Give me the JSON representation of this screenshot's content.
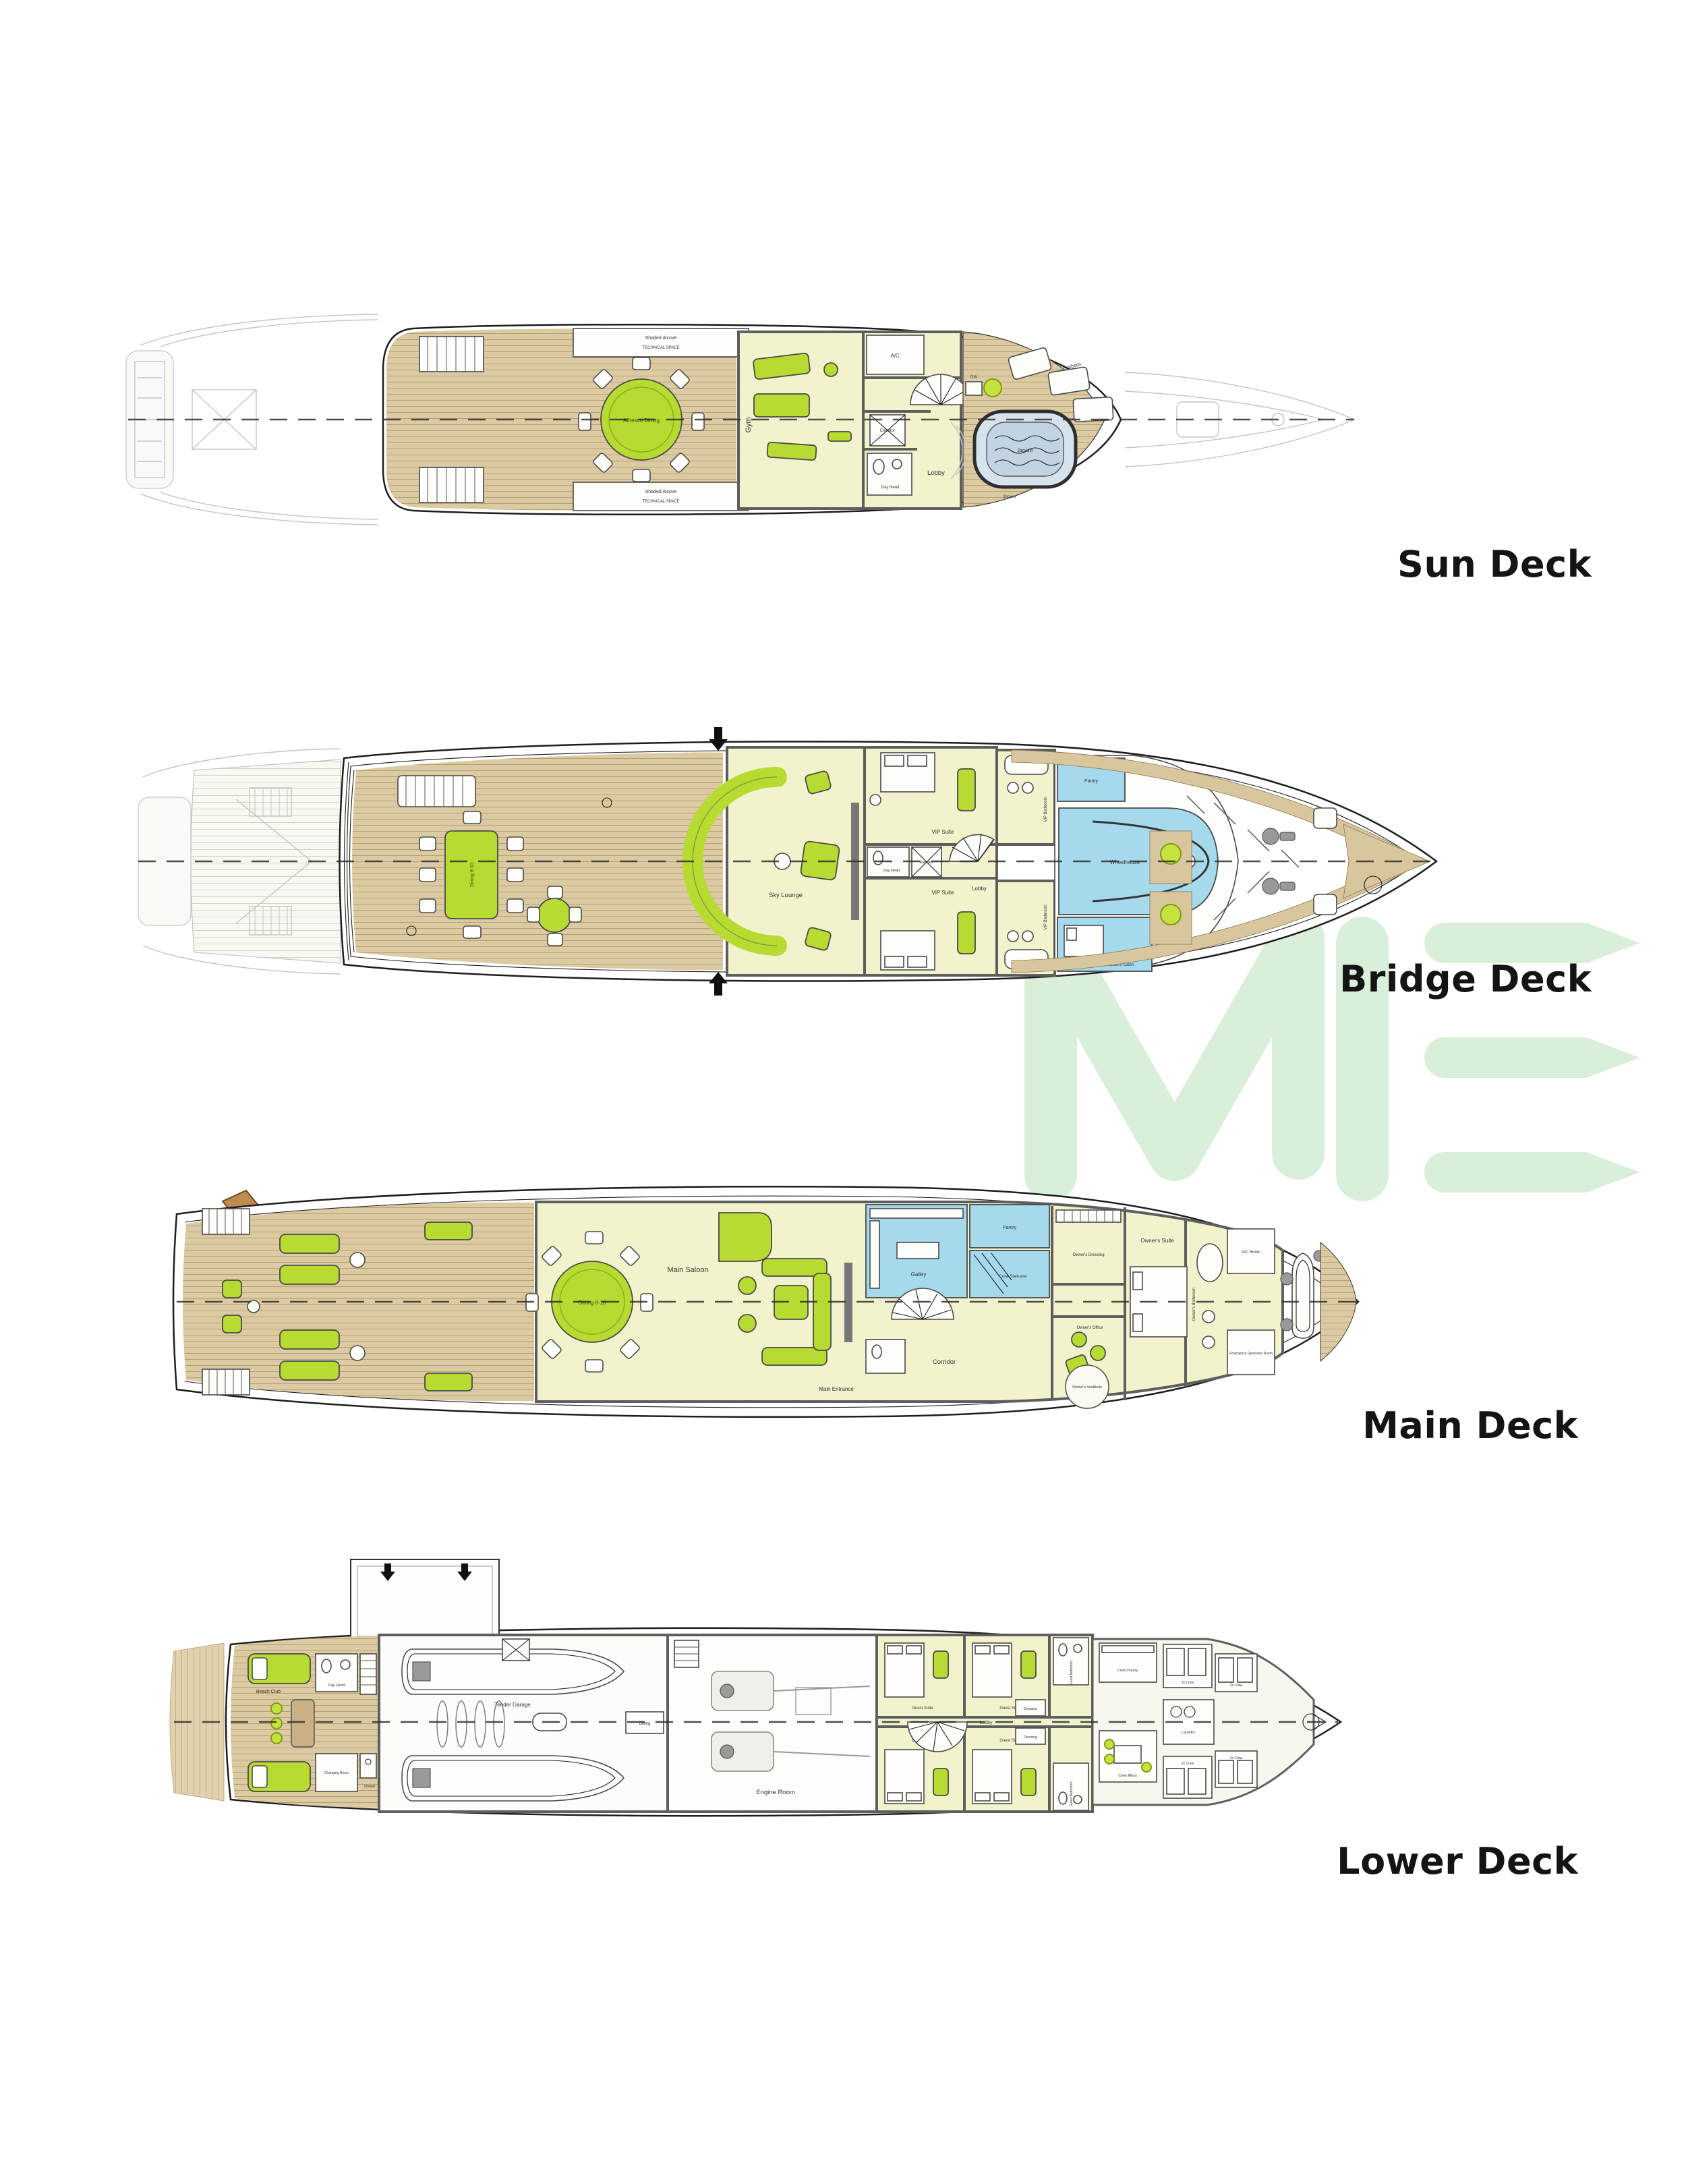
{
  "page": {
    "background_color": "#ffffff"
  },
  "watermark": {
    "name": "brand-logo-watermark",
    "color": "#daefd9"
  },
  "colors": {
    "deck_wood": "#d9c69d",
    "interior_room": "#f2f2cd",
    "service_blue": "#a5d9ec",
    "furniture_green": "#b8db32",
    "jacuzzi_blue": "#c2d4e2",
    "walls": "#5e5e5e",
    "label_text": "#141414"
  },
  "decks": [
    {
      "label": "Sun Deck",
      "rooms": {
        "shaded_alcove": "Shaded Alcove",
        "technical_space": "TECHNICAL SPACE",
        "alfresco_dining": "Alfresco Dining",
        "gym": "Gym",
        "ac": "A/C",
        "elevator": "Elevator",
        "lobby": "Lobby",
        "day_head": "Day Head",
        "dw": "DW",
        "jacuzzi": "Jacuzzi",
        "sunbeds": "Sunbeds",
        "shower": "Shower"
      }
    },
    {
      "label": "Bridge Deck",
      "rooms": {
        "dining": "Dining 8-10",
        "sky_lounge": "Sky Lounge",
        "vip_suite_port": "VIP Suite",
        "vip_suite_stbd": "VIP Suite",
        "vip_bathroom_port": "VIP Bathroom",
        "vip_bathroom_stbd": "VIP Bathroom",
        "day_head": "Day Head",
        "elevator": "Elevator",
        "lobby": "Lobby",
        "pantry": "Pantry",
        "wheelhouse": "Wheelhouse",
        "captains_cabin": "Captain's Cabin"
      }
    },
    {
      "label": "Main Deck",
      "rooms": {
        "main_saloon": "Main Saloon",
        "dining": "Dining 8-10",
        "galley": "Galley",
        "pantry": "Pantry",
        "crew_staircase": "Crew Staircase",
        "corridor": "Corridor",
        "main_entrance": "Main Entrance",
        "owners_dressing": "Owner's Dressing",
        "owners_suite": "Owner's Suite",
        "owners_bathroom": "Owner's Bathroom",
        "owners_office": "Owner's Office",
        "owners_vestibule": "Owner's Vestibule",
        "ac_room": "A/C Room",
        "generator_room": "Emergency Generator Room"
      }
    },
    {
      "label": "Lower Deck",
      "rooms": {
        "beach_club": "Beach Club",
        "day_head": "Day Head",
        "changing_room": "Changing Room",
        "shower": "Shower",
        "tender_garage": "Tender Garage",
        "diving": "Diving",
        "engine_room": "Engine Room",
        "guest_suite_1": "Guest Suite",
        "guest_suite_2": "Guest Suite",
        "guest_suite_3": "Guest Suite",
        "guest_suite_4": "Guest Suite",
        "guest_bathroom": "Guest Bathroom",
        "dressing": "Dressing",
        "lobby": "Lobby",
        "dw": "DW",
        "crew_mess": "Crew Mess",
        "crew_pantry": "Crew Pantry",
        "crew_cabin": "2x Crew",
        "laundry": "Laundry"
      }
    }
  ]
}
